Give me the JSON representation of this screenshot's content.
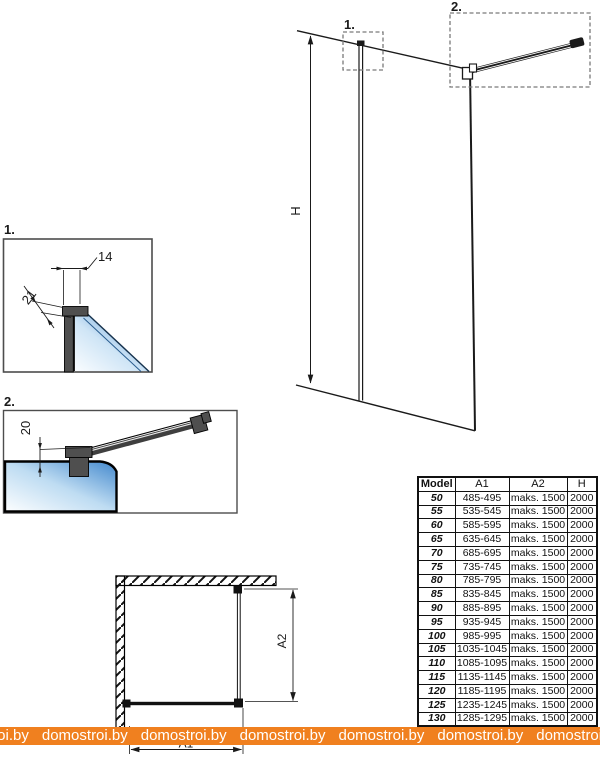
{
  "drawing": {
    "callout1_label": "1.",
    "callout2_label": "2.",
    "detail1_label": "1.",
    "detail2_label": "2.",
    "height_dim_label": "H",
    "dim_14_label": "14",
    "dim_21_label": "21",
    "dim_20_label": "20",
    "dim_a1_label": "A1",
    "dim_a2_label": "A2"
  },
  "table": {
    "headers": [
      "Model",
      "A1",
      "A2",
      "H"
    ],
    "rows": [
      [
        "50",
        "485-495",
        "maks. 1500",
        "2000"
      ],
      [
        "55",
        "535-545",
        "maks. 1500",
        "2000"
      ],
      [
        "60",
        "585-595",
        "maks. 1500",
        "2000"
      ],
      [
        "65",
        "635-645",
        "maks. 1500",
        "2000"
      ],
      [
        "70",
        "685-695",
        "maks. 1500",
        "2000"
      ],
      [
        "75",
        "735-745",
        "maks. 1500",
        "2000"
      ],
      [
        "80",
        "785-795",
        "maks. 1500",
        "2000"
      ],
      [
        "85",
        "835-845",
        "maks. 1500",
        "2000"
      ],
      [
        "90",
        "885-895",
        "maks. 1500",
        "2000"
      ],
      [
        "95",
        "935-945",
        "maks. 1500",
        "2000"
      ],
      [
        "100",
        "985-995",
        "maks. 1500",
        "2000"
      ],
      [
        "105",
        "1035-1045",
        "maks. 1500",
        "2000"
      ],
      [
        "110",
        "1085-1095",
        "maks. 1500",
        "2000"
      ],
      [
        "115",
        "1135-1145",
        "maks. 1500",
        "2000"
      ],
      [
        "120",
        "1185-1195",
        "maks. 1500",
        "2000"
      ],
      [
        "125",
        "1235-1245",
        "maks. 1500",
        "2000"
      ],
      [
        "130",
        "1285-1295",
        "maks. 1500",
        "2000"
      ]
    ]
  },
  "watermark": {
    "text": "domostroi.by",
    "repeat": 7,
    "band_color": "#F0801F",
    "text_color": "#FFFFFF"
  },
  "colors": {
    "line_black": "#1a1a1a",
    "profile_gray": "#4F4F4F",
    "glass_blue": "#4288CD",
    "glass_light": "#FBFDFF",
    "dash_gray": "#7a7a7a"
  }
}
